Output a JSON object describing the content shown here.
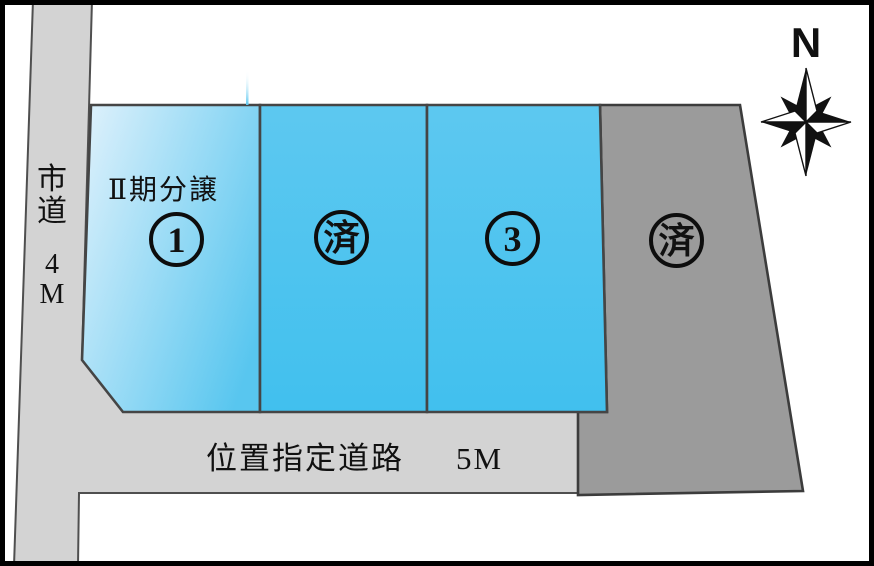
{
  "compass": {
    "label": "N"
  },
  "roads": {
    "left": {
      "name": "市道",
      "name_display": "市\n道",
      "width": "4M",
      "width_display": "4\nM"
    },
    "bottom": {
      "name": "位置指定道路",
      "width": "5M"
    }
  },
  "phase_label": "Ⅱ期分譲",
  "lots": [
    {
      "id": "lot-1",
      "label": "1",
      "marker": "①",
      "note": "Ⅱ期分譲",
      "fill": "blue-gradient"
    },
    {
      "id": "lot-2",
      "label": "済",
      "marker": "済",
      "fill": "blue"
    },
    {
      "id": "lot-3",
      "label": "3",
      "marker": "③",
      "fill": "blue"
    },
    {
      "id": "lot-4",
      "label": "済",
      "marker": "済",
      "fill": "gray"
    }
  ],
  "colors": {
    "road": "#d3d3d3",
    "road_line": "#4f4f4f",
    "lot_line": "#454545",
    "lot1_light": "#d8effb",
    "lot1_deep": "#58c6ef",
    "lot_blue_top": "#5dc8f0",
    "lot_blue": "#41c0ee",
    "lot_gray": "#9b9b9b",
    "ink": "#111111",
    "white": "#ffffff"
  }
}
